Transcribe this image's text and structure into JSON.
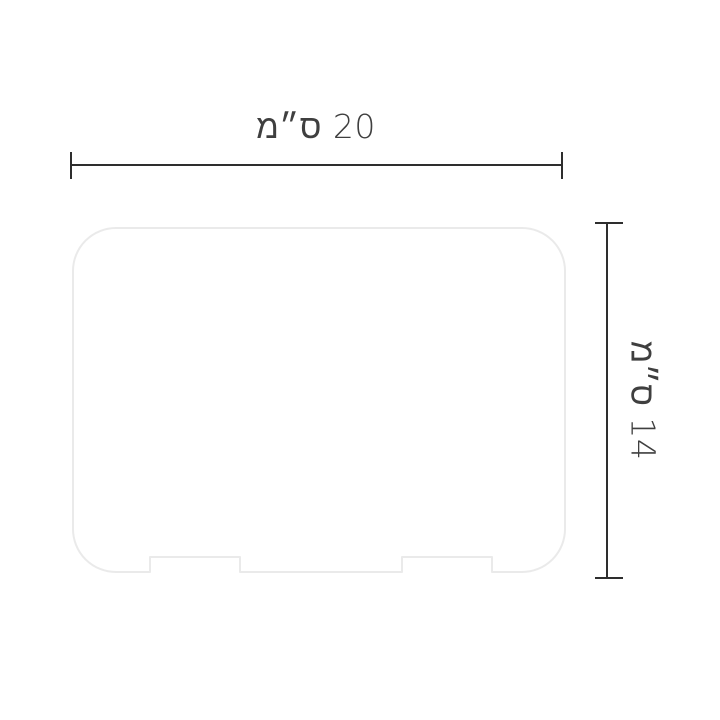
{
  "dimensions": {
    "width": {
      "value": "20",
      "unit": "ס״מ",
      "label": "20 ס״מ"
    },
    "height": {
      "value": "14",
      "unit": "ס״מ",
      "label": "14 ס״מ"
    }
  },
  "colors": {
    "background": "#ffffff",
    "dimension_line": "#2e2e2e",
    "label_text": "#3f3f3f",
    "shape_outline": "#eaeaea",
    "shape_fill": "#ffffff"
  }
}
